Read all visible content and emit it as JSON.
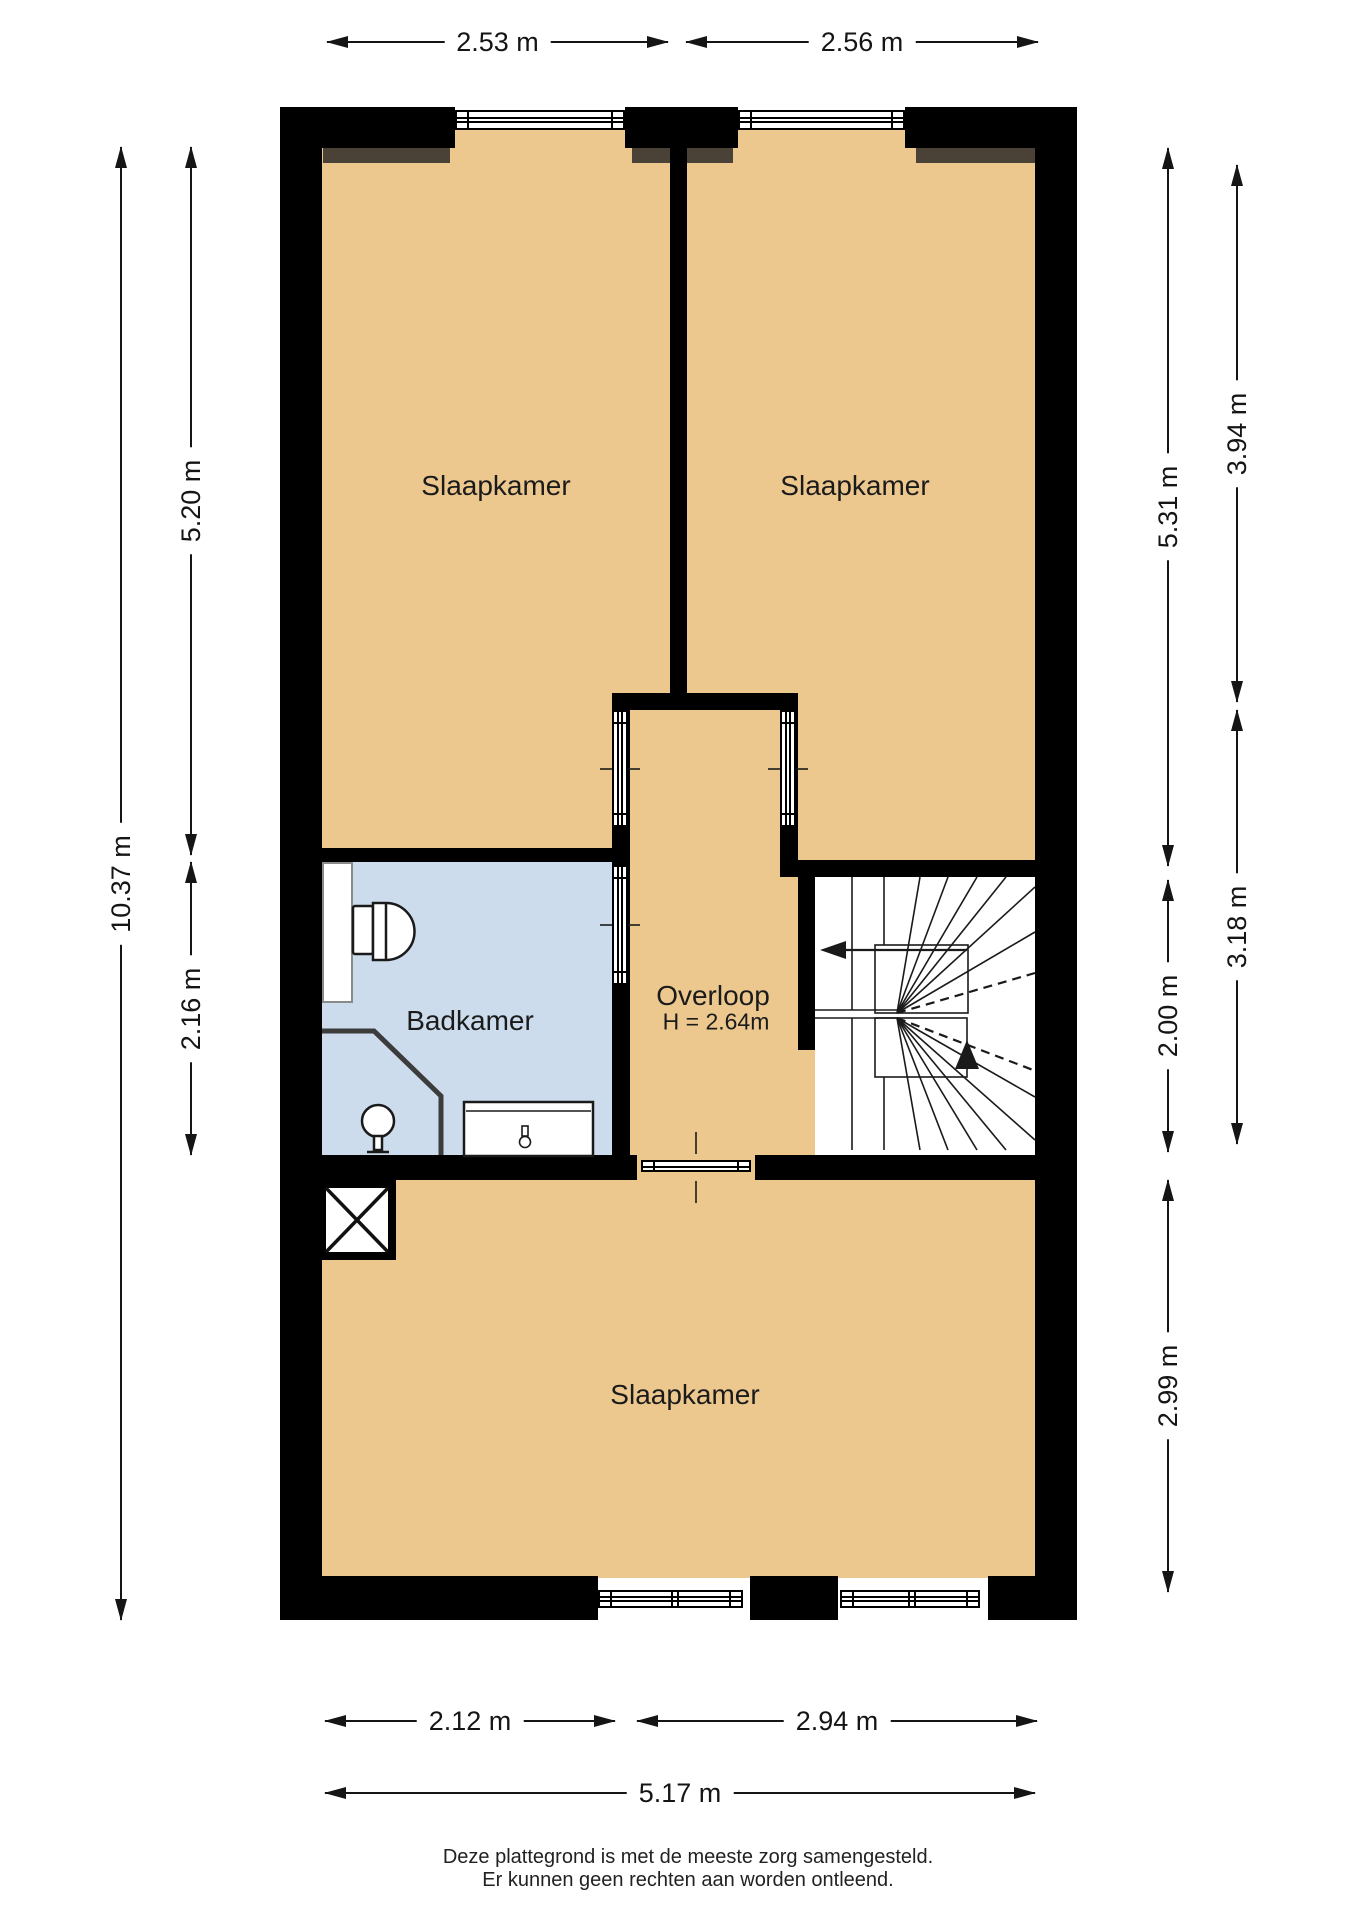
{
  "rooms": {
    "bedroom_top_left": {
      "label": "Slaapkamer"
    },
    "bedroom_top_right": {
      "label": "Slaapkamer"
    },
    "bathroom": {
      "label": "Badkamer"
    },
    "landing": {
      "label": "Overloop",
      "height_note": "H = 2.64m"
    },
    "bedroom_bottom": {
      "label": "Slaapkamer"
    }
  },
  "dimensions": {
    "top": [
      {
        "label": "2.53 m"
      },
      {
        "label": "2.56 m"
      }
    ],
    "bottom": [
      {
        "label": "2.12 m"
      },
      {
        "label": "2.94 m"
      },
      {
        "label": "5.17 m"
      }
    ],
    "left": [
      {
        "label": "10.37 m"
      },
      {
        "label": "5.20 m"
      },
      {
        "label": "2.16 m"
      }
    ],
    "right": [
      {
        "label": "5.31 m"
      },
      {
        "label": "2.00 m"
      },
      {
        "label": "2.99 m"
      },
      {
        "label": "3.94 m"
      },
      {
        "label": "3.18 m"
      }
    ]
  },
  "footer": {
    "line1": "Deze plattegrond is met de meeste zorg samengesteld.",
    "line2": "Er kunnen geen rechten aan worden ontleend."
  },
  "colors": {
    "floor": "#ecc88e",
    "bathroom_floor": "#ccdcec",
    "wall": "#000000",
    "accent_dark": "#4a4237",
    "line": "#151515"
  }
}
